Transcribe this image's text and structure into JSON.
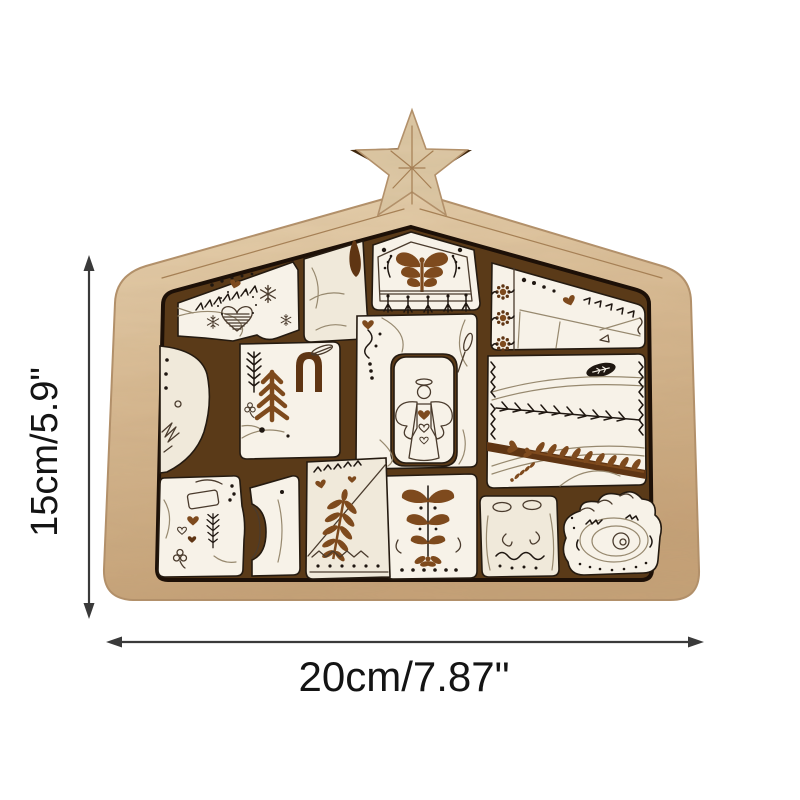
{
  "image": {
    "type": "product dimension photo",
    "subject": "wooden nativity puzzle in house-shaped frame with star topper"
  },
  "annotations": {
    "height_label": "15cm/5.9\"",
    "width_label": "20cm/7.87\""
  },
  "motifs": [
    "star-icon",
    "goose-icon",
    "fir-tree-icon",
    "donkey-icon",
    "ox-icon",
    "angel-icon",
    "sheep-icon",
    "manger-icon",
    "heart-icon",
    "fern-icon",
    "rosette-icon",
    "snowflake-icon",
    "banner-fringe-icon"
  ],
  "colors": {
    "frame_wood": "#d8ba93",
    "frame_wood_light": "#e9d4b2",
    "frame_wood_dark": "#c5a177",
    "frame_edge": "#b3906a",
    "backing": "#5a3a18",
    "gap_dark": "#241a10",
    "piece_face": "#f7f2e8",
    "piece_face_warm": "#f0e9da",
    "line_art": "#4a3b2d",
    "line_dark": "#1f1711",
    "line_faint": "#97896f",
    "accent_rust": "#7e4a1d",
    "accent_rust_dark": "#5f3513",
    "etch": "#a57e52",
    "dimension_line": "#3a3a3a",
    "dimension_text": "#141414",
    "background": "#ffffff"
  }
}
